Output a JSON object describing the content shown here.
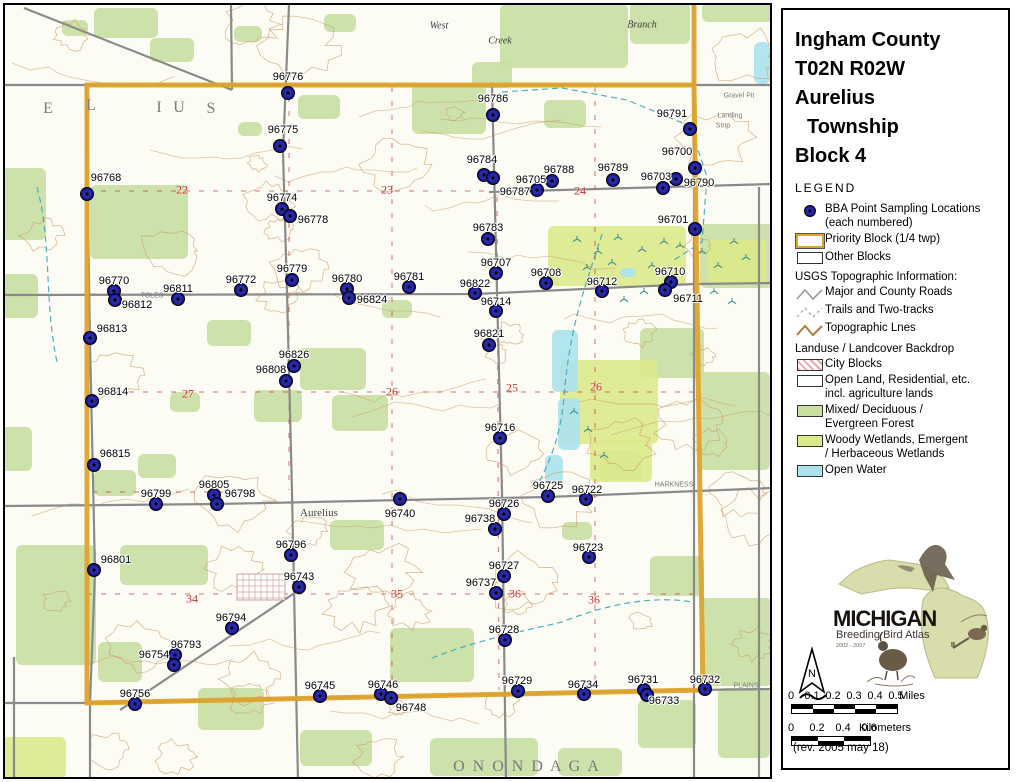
{
  "panel": {
    "title_lines": [
      "Ingham County",
      "T02N R02W",
      "Aurelius",
      "Township",
      "Block 4"
    ],
    "legend_heading": "LEGEND",
    "legend": {
      "bba": [
        "BBA Point Sampling Locations",
        "(each numbered)"
      ],
      "priority": "Priority Block (1/4 twp)",
      "other": "Other Blocks",
      "usgs_heading": "USGS Topographic Information:",
      "roads": "Major and County Roads",
      "trails": "Trails and Two-tracks",
      "topo": "Topographic Lnes",
      "landuse_heading": "Landuse / Landcover Backdrop",
      "city": "City Blocks",
      "open_land": [
        "Open Land, Residential, etc.",
        "incl. agriculture lands"
      ],
      "forest": [
        "Mixed/ Deciduous /",
        "Evergreen Forest"
      ],
      "wetland": [
        "Woody Wetlands, Emergent",
        "/ Herbaceous Wetlands"
      ],
      "water": "Open Water"
    },
    "logo": {
      "name": "MICHIGAN",
      "subtitle": "Breeding Bird Atlas",
      "years": "2002 - 2007",
      "numeral": "II"
    },
    "north_label": "N",
    "scale_miles": {
      "ticks": [
        "0",
        "0.1",
        "0.2",
        "0.3",
        "0.4",
        "0.5"
      ],
      "unit": "Miles"
    },
    "scale_km": {
      "ticks": [
        "0",
        "0.2",
        "0.4",
        "0.6"
      ],
      "unit": "Kilometers"
    },
    "revision": "(rev. 2005 may 18)"
  },
  "map": {
    "points": [
      {
        "id": "96776",
        "x": 286,
        "y": 91,
        "lx": 286,
        "ly": 75
      },
      {
        "id": "96775",
        "x": 278,
        "y": 144,
        "lx": 281,
        "ly": 128
      },
      {
        "id": "96768",
        "x": 85,
        "y": 192,
        "lx": 104,
        "ly": 176
      },
      {
        "id": "96786",
        "x": 491,
        "y": 113,
        "lx": 491,
        "ly": 97
      },
      {
        "id": "96791",
        "x": 688,
        "y": 127,
        "lx": 670,
        "ly": 112
      },
      {
        "id": "96700",
        "x": 693,
        "y": 166,
        "lx": 675,
        "ly": 150
      },
      {
        "id": "96784",
        "x": 482,
        "y": 173,
        "lx": 480,
        "ly": 158
      },
      {
        "id": "96787",
        "x": 491,
        "y": 176,
        "lx": 513,
        "ly": 190
      },
      {
        "id": "96705",
        "x": 535,
        "y": 188,
        "lx": 529,
        "ly": 178
      },
      {
        "id": "96788",
        "x": 550,
        "y": 179,
        "lx": 557,
        "ly": 168
      },
      {
        "id": "96789",
        "x": 611,
        "y": 178,
        "lx": 611,
        "ly": 166
      },
      {
        "id": "96703",
        "x": 674,
        "y": 177,
        "lx": 654,
        "ly": 175
      },
      {
        "id": "96790",
        "x": 661,
        "y": 186,
        "lx": 697,
        "ly": 181
      },
      {
        "id": "96701",
        "x": 693,
        "y": 227,
        "lx": 671,
        "ly": 218
      },
      {
        "id": "96774",
        "x": 280,
        "y": 207,
        "lx": 280,
        "ly": 196
      },
      {
        "id": "96778",
        "x": 288,
        "y": 214,
        "lx": 311,
        "ly": 218
      },
      {
        "id": "96783",
        "x": 486,
        "y": 237,
        "lx": 486,
        "ly": 226
      },
      {
        "id": "96770",
        "x": 112,
        "y": 289,
        "lx": 112,
        "ly": 279
      },
      {
        "id": "96812",
        "x": 113,
        "y": 298,
        "lx": 135,
        "ly": 303
      },
      {
        "id": "96811",
        "x": 176,
        "y": 297,
        "lx": 176,
        "ly": 287
      },
      {
        "id": "96772",
        "x": 239,
        "y": 288,
        "lx": 239,
        "ly": 278
      },
      {
        "id": "96779",
        "x": 290,
        "y": 278,
        "lx": 290,
        "ly": 267
      },
      {
        "id": "96780",
        "x": 345,
        "y": 287,
        "lx": 345,
        "ly": 277
      },
      {
        "id": "96824",
        "x": 347,
        "y": 296,
        "lx": 370,
        "ly": 298
      },
      {
        "id": "96781",
        "x": 407,
        "y": 285,
        "lx": 407,
        "ly": 275
      },
      {
        "id": "96813",
        "x": 88,
        "y": 336,
        "lx": 110,
        "ly": 327
      },
      {
        "id": "96707",
        "x": 494,
        "y": 271,
        "lx": 494,
        "ly": 261
      },
      {
        "id": "96708",
        "x": 544,
        "y": 281,
        "lx": 544,
        "ly": 271
      },
      {
        "id": "96822",
        "x": 473,
        "y": 291,
        "lx": 473,
        "ly": 282
      },
      {
        "id": "96712",
        "x": 600,
        "y": 289,
        "lx": 600,
        "ly": 280
      },
      {
        "id": "96710",
        "x": 669,
        "y": 280,
        "lx": 668,
        "ly": 270
      },
      {
        "id": "96711",
        "x": 663,
        "y": 288,
        "lx": 686,
        "ly": 297
      },
      {
        "id": "96714",
        "x": 494,
        "y": 309,
        "lx": 494,
        "ly": 300
      },
      {
        "id": "96821",
        "x": 487,
        "y": 343,
        "lx": 487,
        "ly": 332
      },
      {
        "id": "96826",
        "x": 292,
        "y": 364,
        "lx": 292,
        "ly": 353
      },
      {
        "id": "96808",
        "x": 284,
        "y": 379,
        "lx": 269,
        "ly": 368
      },
      {
        "id": "96814",
        "x": 90,
        "y": 399,
        "lx": 111,
        "ly": 390
      },
      {
        "id": "96815",
        "x": 92,
        "y": 463,
        "lx": 113,
        "ly": 452
      },
      {
        "id": "96805",
        "x": 212,
        "y": 493,
        "lx": 212,
        "ly": 483
      },
      {
        "id": "96799",
        "x": 154,
        "y": 502,
        "lx": 154,
        "ly": 492
      },
      {
        "id": "96798",
        "x": 215,
        "y": 502,
        "lx": 238,
        "ly": 492
      },
      {
        "id": "96740",
        "x": 398,
        "y": 497,
        "lx": 398,
        "ly": 512
      },
      {
        "id": "96716",
        "x": 498,
        "y": 436,
        "lx": 498,
        "ly": 426
      },
      {
        "id": "96725",
        "x": 546,
        "y": 494,
        "lx": 546,
        "ly": 484
      },
      {
        "id": "96722",
        "x": 584,
        "y": 497,
        "lx": 585,
        "ly": 488
      },
      {
        "id": "96726",
        "x": 502,
        "y": 512,
        "lx": 502,
        "ly": 502
      },
      {
        "id": "96738",
        "x": 493,
        "y": 527,
        "lx": 478,
        "ly": 517
      },
      {
        "id": "96723",
        "x": 587,
        "y": 555,
        "lx": 586,
        "ly": 546
      },
      {
        "id": "96727",
        "x": 502,
        "y": 574,
        "lx": 502,
        "ly": 564
      },
      {
        "id": "96737",
        "x": 494,
        "y": 591,
        "lx": 479,
        "ly": 581
      },
      {
        "id": "96801",
        "x": 92,
        "y": 568,
        "lx": 114,
        "ly": 558
      },
      {
        "id": "96796",
        "x": 289,
        "y": 553,
        "lx": 289,
        "ly": 543
      },
      {
        "id": "96743",
        "x": 297,
        "y": 585,
        "lx": 297,
        "ly": 575
      },
      {
        "id": "96794",
        "x": 230,
        "y": 626,
        "lx": 229,
        "ly": 616
      },
      {
        "id": "96793",
        "x": 173,
        "y": 653,
        "lx": 184,
        "ly": 643
      },
      {
        "id": "96754",
        "x": 172,
        "y": 663,
        "lx": 152,
        "ly": 653
      },
      {
        "id": "96756",
        "x": 133,
        "y": 702,
        "lx": 133,
        "ly": 692
      },
      {
        "id": "96745",
        "x": 318,
        "y": 694,
        "lx": 318,
        "ly": 684
      },
      {
        "id": "96746",
        "x": 379,
        "y": 692,
        "lx": 381,
        "ly": 683
      },
      {
        "id": "96748",
        "x": 389,
        "y": 696,
        "lx": 409,
        "ly": 706
      },
      {
        "id": "96728",
        "x": 503,
        "y": 638,
        "lx": 502,
        "ly": 628
      },
      {
        "id": "96729",
        "x": 516,
        "y": 689,
        "lx": 515,
        "ly": 679
      },
      {
        "id": "96734",
        "x": 582,
        "y": 692,
        "lx": 581,
        "ly": 683
      },
      {
        "id": "96731",
        "x": 642,
        "y": 688,
        "lx": 641,
        "ly": 678
      },
      {
        "id": "96733",
        "x": 645,
        "y": 693,
        "lx": 662,
        "ly": 699
      },
      {
        "id": "96732",
        "x": 703,
        "y": 687,
        "lx": 703,
        "ly": 678
      }
    ],
    "section_numbers": [
      {
        "n": "22",
        "x": 180,
        "y": 188
      },
      {
        "n": "23",
        "x": 385,
        "y": 188
      },
      {
        "n": "24",
        "x": 578,
        "y": 189
      },
      {
        "n": "27",
        "x": 186,
        "y": 392
      },
      {
        "n": "26",
        "x": 390,
        "y": 390
      },
      {
        "n": "25",
        "x": 510,
        "y": 386
      },
      {
        "n": "26",
        "x": 594,
        "y": 385
      },
      {
        "n": "34",
        "x": 190,
        "y": 597
      },
      {
        "n": "35",
        "x": 395,
        "y": 592
      },
      {
        "n": "36",
        "x": 513,
        "y": 592
      },
      {
        "n": "36",
        "x": 592,
        "y": 598
      }
    ],
    "place_labels": [
      {
        "t": "E",
        "x": 47,
        "y": 107,
        "kind": "township"
      },
      {
        "t": "L",
        "x": 90,
        "y": 104,
        "kind": "township"
      },
      {
        "t": "I",
        "x": 158,
        "y": 106,
        "kind": "township"
      },
      {
        "t": "U",
        "x": 178,
        "y": 106,
        "kind": "township"
      },
      {
        "t": "S",
        "x": 210,
        "y": 107,
        "kind": "township"
      },
      {
        "t": "O N O N D A G A",
        "x": 525,
        "y": 765,
        "kind": "township"
      },
      {
        "t": "Aurelius",
        "x": 317,
        "y": 511,
        "kind": "town"
      },
      {
        "t": "West",
        "x": 437,
        "y": 24,
        "kind": "water"
      },
      {
        "t": "Branch",
        "x": 640,
        "y": 23,
        "kind": "water"
      },
      {
        "t": "Creek",
        "x": 498,
        "y": 39,
        "kind": "water"
      },
      {
        "t": "Gravel Pit",
        "x": 737,
        "y": 94,
        "kind": "tiny"
      },
      {
        "t": "Landing",
        "x": 728,
        "y": 114,
        "kind": "tiny"
      },
      {
        "t": "Strip",
        "x": 721,
        "y": 124,
        "kind": "tiny"
      },
      {
        "t": "HARKNESS",
        "x": 672,
        "y": 483,
        "kind": "tiny"
      },
      {
        "t": "PLAINS",
        "x": 744,
        "y": 684,
        "kind": "tiny"
      },
      {
        "t": "TOLES",
        "x": 150,
        "y": 294,
        "kind": "tiny"
      }
    ]
  },
  "colors": {
    "point": "#15158a",
    "priority_border": "#dfa32c",
    "forest": "#c8dfa2",
    "wetland": "#dbe98b",
    "water": "#abe2ee",
    "contour": "#c89a66",
    "road": "#8a8a8a",
    "section_red": "#cc3333"
  }
}
